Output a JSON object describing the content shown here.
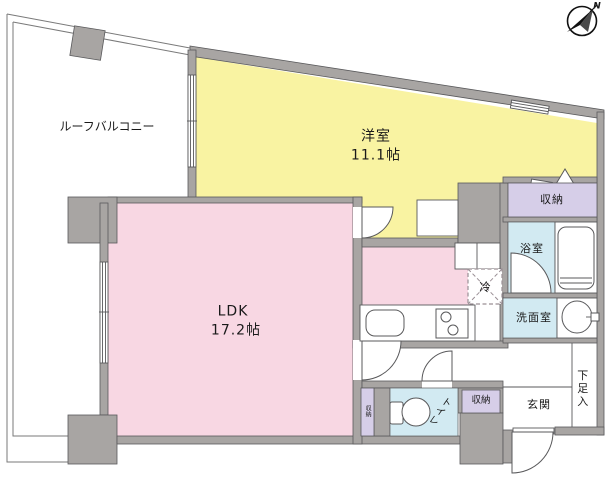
{
  "title": "apartment-floor-plan",
  "compass": {
    "north_label": "N"
  },
  "rooms": {
    "balcony": {
      "label": "ルーフバルコニー"
    },
    "western_room": {
      "label": "洋室",
      "size": "11.1帖"
    },
    "ldk": {
      "label": "LDK",
      "size": "17.2帖"
    },
    "closet_top": {
      "label": "収納"
    },
    "bathroom": {
      "label": "浴室"
    },
    "washroom": {
      "label": "洗面室"
    },
    "shoe_cabinet": {
      "label": "下足入"
    },
    "entrance": {
      "label": "玄関"
    },
    "closet_hall": {
      "label": "収納"
    },
    "closet_strip": {
      "label": "収納"
    },
    "toilet": {
      "label": "トイレ"
    },
    "refrigerator": {
      "label": "冷"
    }
  },
  "colors": {
    "wall": "#a8a5a3",
    "outline": "#59595b",
    "room_yellow": "#f9f3a2",
    "room_pink": "#f8d7e3",
    "room_blue": "#d2eaf2",
    "room_lavender": "#d6cee8"
  }
}
